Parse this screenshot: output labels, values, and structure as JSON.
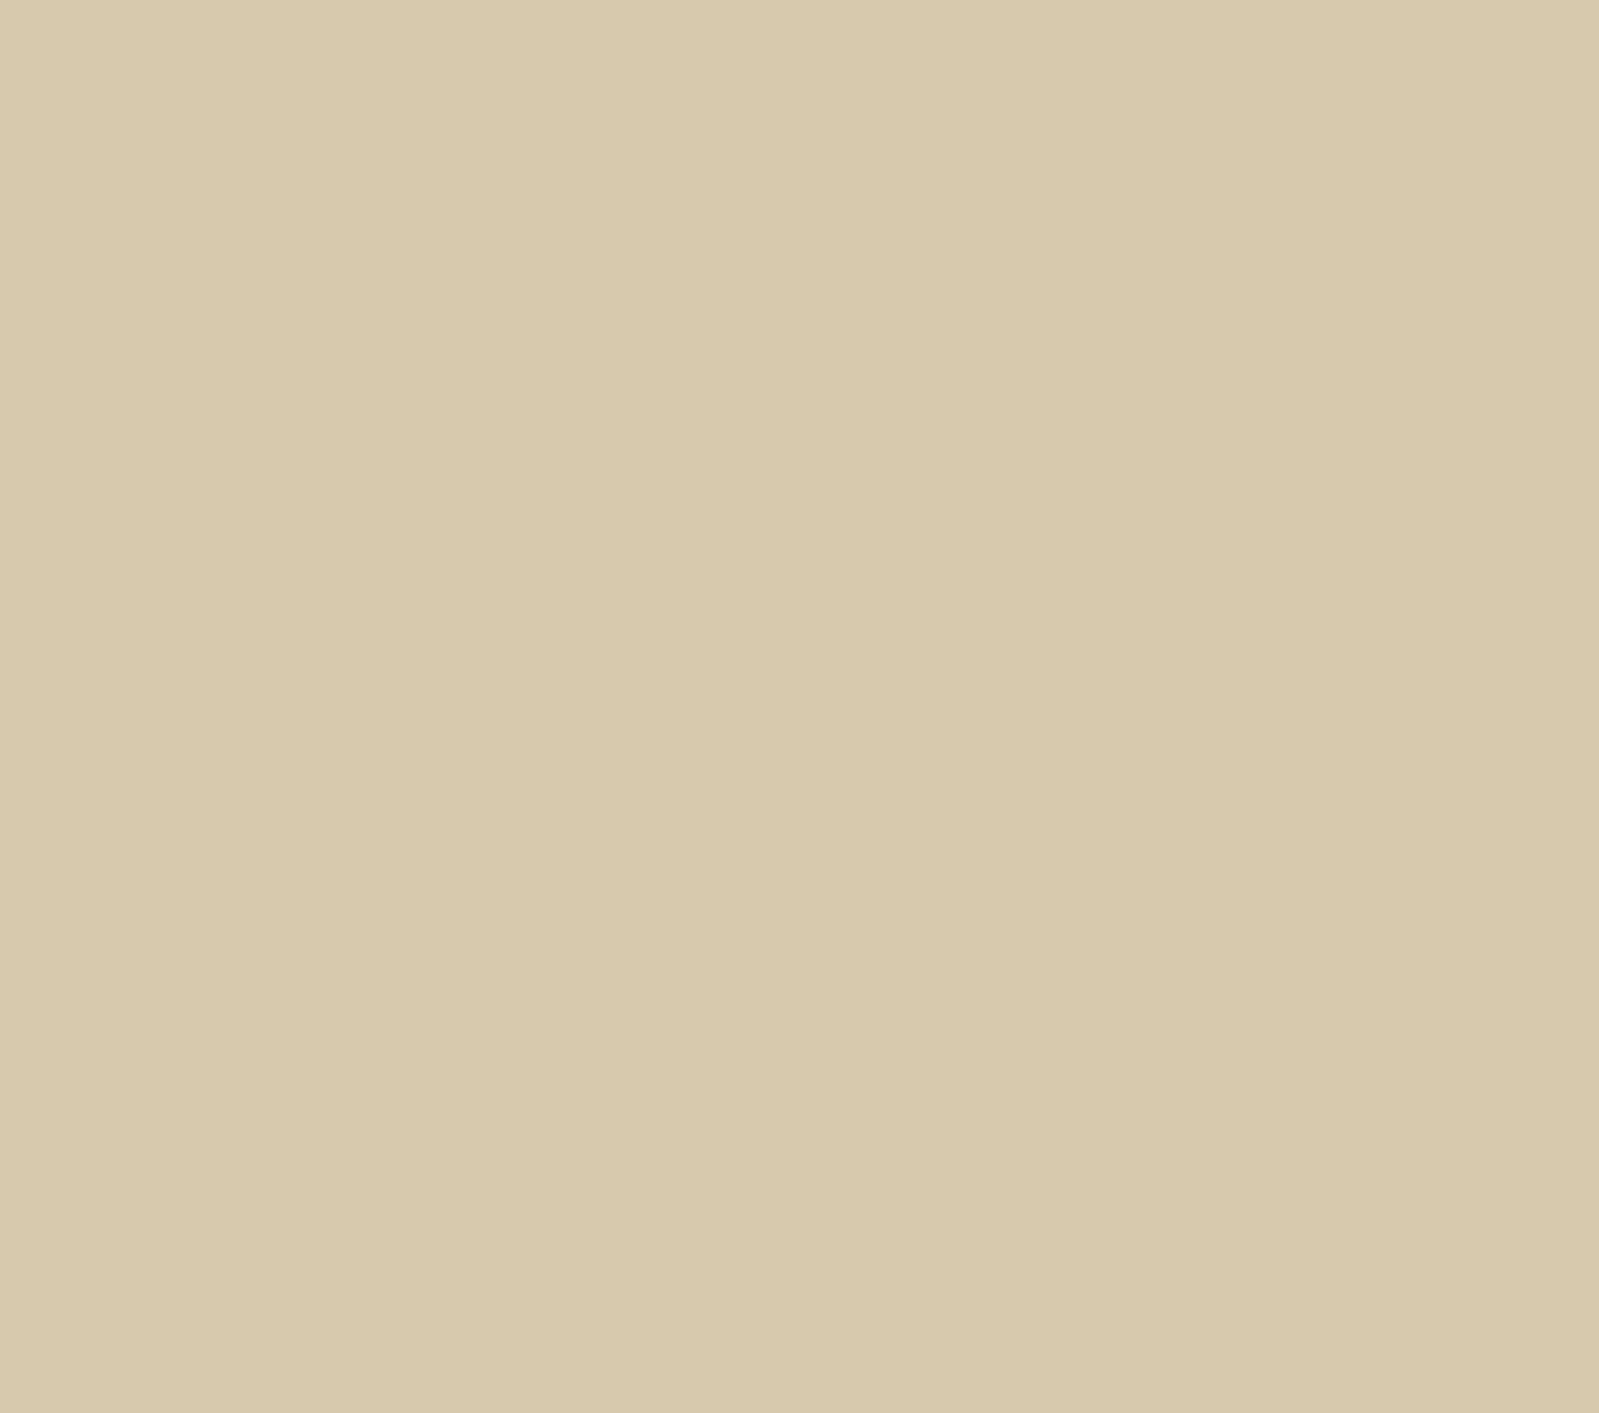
{
  "colors": {
    "paper": "#d7c9ad",
    "ink": "#2f2c31",
    "route": "#8f4549",
    "marker": "#883a40",
    "marker_text": "#e6d4b2"
  },
  "north": {
    "label": "Nord"
  },
  "parking": {
    "label": "P"
  },
  "labels": [
    {
      "id": "vers-le-col-1",
      "text": "vers le col",
      "x": 898,
      "y": 106,
      "size": 29,
      "rot": -14
    },
    {
      "id": "vers-le-col-2",
      "text": "de la Faucile",
      "x": 912,
      "y": 150,
      "size": 29,
      "rot": -12
    },
    {
      "id": "rue-de-paris",
      "text": "Rue de Paris",
      "x": 828,
      "y": 185,
      "size": 23,
      "rot": 80
    },
    {
      "id": "place-abbr",
      "text": "Pl.",
      "x": 872,
      "y": 392,
      "size": 23,
      "rot": 0
    },
    {
      "id": "place-name",
      "text": "Perdtemps",
      "x": 836,
      "y": 426,
      "size": 18,
      "rot": 3
    },
    {
      "id": "av-de",
      "text": "Av. de",
      "x": 1437,
      "y": 537,
      "size": 26,
      "rot": -6
    },
    {
      "id": "av-de-t",
      "text": "T",
      "x": 1578,
      "y": 521,
      "size": 26,
      "rot": -6
    },
    {
      "id": "river-name",
      "text": "(Journans)",
      "x": 124,
      "y": 492,
      "size": 15,
      "rot": -83
    },
    {
      "id": "avenue-poste",
      "text": "Avenue de la Poste",
      "x": 1161,
      "y": 1104,
      "size": 25,
      "rot": -52
    },
    {
      "id": "avenue-gare",
      "text": "Avenue de la Gare",
      "x": 1048,
      "y": 1222,
      "size": 31,
      "rot": -7
    },
    {
      "id": "gare-cut",
      "text": "Gar-",
      "x": 1540,
      "y": 872,
      "size": 23,
      "rot": -6
    }
  ],
  "waypoints": [
    {
      "n": "1",
      "x": 1122,
      "y": 1152
    },
    {
      "n": "2",
      "x": 1030,
      "y": 1067
    },
    {
      "n": "3",
      "x": 850,
      "y": 990
    },
    {
      "n": "4",
      "x": 1090,
      "y": 797
    },
    {
      "n": "5",
      "x": 1237,
      "y": 806
    },
    {
      "n": "6",
      "x": 1433,
      "y": 795
    },
    {
      "n": "8",
      "x": 985,
      "y": 793
    },
    {
      "n": "9",
      "x": 925,
      "y": 787
    },
    {
      "n": "10",
      "x": 830,
      "y": 793
    },
    {
      "n": "11",
      "x": 797,
      "y": 622
    },
    {
      "n": "12",
      "x": 840,
      "y": 648
    },
    {
      "n": "13",
      "x": 942,
      "y": 658
    },
    {
      "n": "14",
      "x": 922,
      "y": 587
    },
    {
      "n": "15",
      "x": 986,
      "y": 563
    },
    {
      "n": "16",
      "x": 1062,
      "y": 640
    },
    {
      "n": "17",
      "x": 1113,
      "y": 598
    },
    {
      "n": "18",
      "x": 1159,
      "y": 542
    },
    {
      "n": "19",
      "x": 1222,
      "y": 335
    },
    {
      "n": "20",
      "x": 1027,
      "y": 398
    },
    {
      "n": "21",
      "x": 963,
      "y": 392
    },
    {
      "n": "22",
      "x": 786,
      "y": 470
    },
    {
      "n": "23",
      "x": 841,
      "y": 535
    },
    {
      "n": "24",
      "x": 677,
      "y": 497
    },
    {
      "n": "25",
      "x": 473,
      "y": 848
    },
    {
      "n": "26",
      "x": 595,
      "y": 886
    },
    {
      "n": "27",
      "x": 714,
      "y": 797
    },
    {
      "n": "28",
      "x": 717,
      "y": 912
    },
    {
      "n": "29",
      "x": 648,
      "y": 980
    },
    {
      "n": "30",
      "x": 597,
      "y": 961
    },
    {
      "n": "31",
      "x": 525,
      "y": 963
    },
    {
      "n": "32",
      "x": 137,
      "y": 853
    },
    {
      "n": "33",
      "x": 779,
      "y": 943
    }
  ],
  "route_polylines": [
    [
      [
        830,
        793
      ],
      [
        925,
        787
      ],
      [
        985,
        793
      ],
      [
        1090,
        797
      ],
      [
        1237,
        806
      ],
      [
        1380,
        792
      ],
      [
        1433,
        795
      ]
    ],
    [
      [
        1433,
        795
      ],
      [
        1452,
        808
      ],
      [
        1500,
        817
      ],
      [
        1599,
        817
      ]
    ],
    [
      [
        1122,
        1152
      ],
      [
        1098,
        1128
      ],
      [
        1048,
        1088
      ],
      [
        1030,
        1067
      ],
      [
        1008,
        1046
      ],
      [
        962,
        1030
      ],
      [
        900,
        1008
      ],
      [
        850,
        990
      ]
    ],
    [
      [
        850,
        990
      ],
      [
        862,
        950
      ],
      [
        885,
        918
      ],
      [
        930,
        882
      ],
      [
        1000,
        840
      ],
      [
        1058,
        812
      ],
      [
        1090,
        797
      ]
    ],
    [
      [
        830,
        793
      ],
      [
        824,
        770
      ],
      [
        845,
        715
      ],
      [
        852,
        690
      ],
      [
        840,
        648
      ]
    ],
    [
      [
        840,
        648
      ],
      [
        900,
        652
      ],
      [
        942,
        657
      ],
      [
        976,
        644
      ],
      [
        984,
        605
      ],
      [
        986,
        563
      ]
    ],
    [
      [
        986,
        563
      ],
      [
        998,
        592
      ],
      [
        1028,
        622
      ],
      [
        1062,
        640
      ],
      [
        1090,
        620
      ],
      [
        1113,
        598
      ]
    ],
    [
      [
        1113,
        598
      ],
      [
        1165,
        567
      ],
      [
        1222,
        540
      ],
      [
        1307,
        497
      ],
      [
        1215,
        358
      ],
      [
        1120,
        386
      ],
      [
        1027,
        398
      ],
      [
        963,
        392
      ]
    ],
    [
      [
        963,
        392
      ],
      [
        935,
        425
      ],
      [
        890,
        447
      ],
      [
        840,
        460
      ],
      [
        786,
        470
      ]
    ],
    [
      [
        786,
        470
      ],
      [
        812,
        500
      ],
      [
        836,
        528
      ]
    ],
    [
      [
        786,
        470
      ],
      [
        730,
        484
      ],
      [
        677,
        497
      ],
      [
        636,
        522
      ],
      [
        574,
        582
      ],
      [
        515,
        650
      ],
      [
        477,
        712
      ],
      [
        455,
        765
      ],
      [
        450,
        805
      ],
      [
        459,
        833
      ],
      [
        473,
        848
      ]
    ],
    [
      [
        473,
        848
      ],
      [
        505,
        865
      ],
      [
        550,
        880
      ],
      [
        595,
        886
      ],
      [
        638,
        879
      ],
      [
        675,
        845
      ],
      [
        700,
        818
      ],
      [
        714,
        797
      ]
    ],
    [
      [
        714,
        797
      ],
      [
        746,
        803
      ],
      [
        764,
        822
      ],
      [
        767,
        847
      ],
      [
        754,
        878
      ],
      [
        735,
        897
      ],
      [
        717,
        912
      ]
    ],
    [
      [
        717,
        912
      ],
      [
        746,
        926
      ],
      [
        779,
        943
      ]
    ],
    [
      [
        717,
        912
      ],
      [
        700,
        936
      ],
      [
        674,
        962
      ],
      [
        648,
        980
      ],
      [
        622,
        974
      ],
      [
        597,
        961
      ],
      [
        570,
        950
      ],
      [
        544,
        955
      ],
      [
        525,
        963
      ]
    ],
    [
      [
        525,
        963
      ],
      [
        513,
        990
      ],
      [
        501,
        1013
      ],
      [
        488,
        1024
      ],
      [
        462,
        1028
      ]
    ],
    [
      [
        525,
        963
      ],
      [
        468,
        944
      ],
      [
        418,
        918
      ],
      [
        340,
        897
      ],
      [
        268,
        890
      ],
      [
        198,
        876
      ],
      [
        137,
        853
      ]
    ]
  ]
}
